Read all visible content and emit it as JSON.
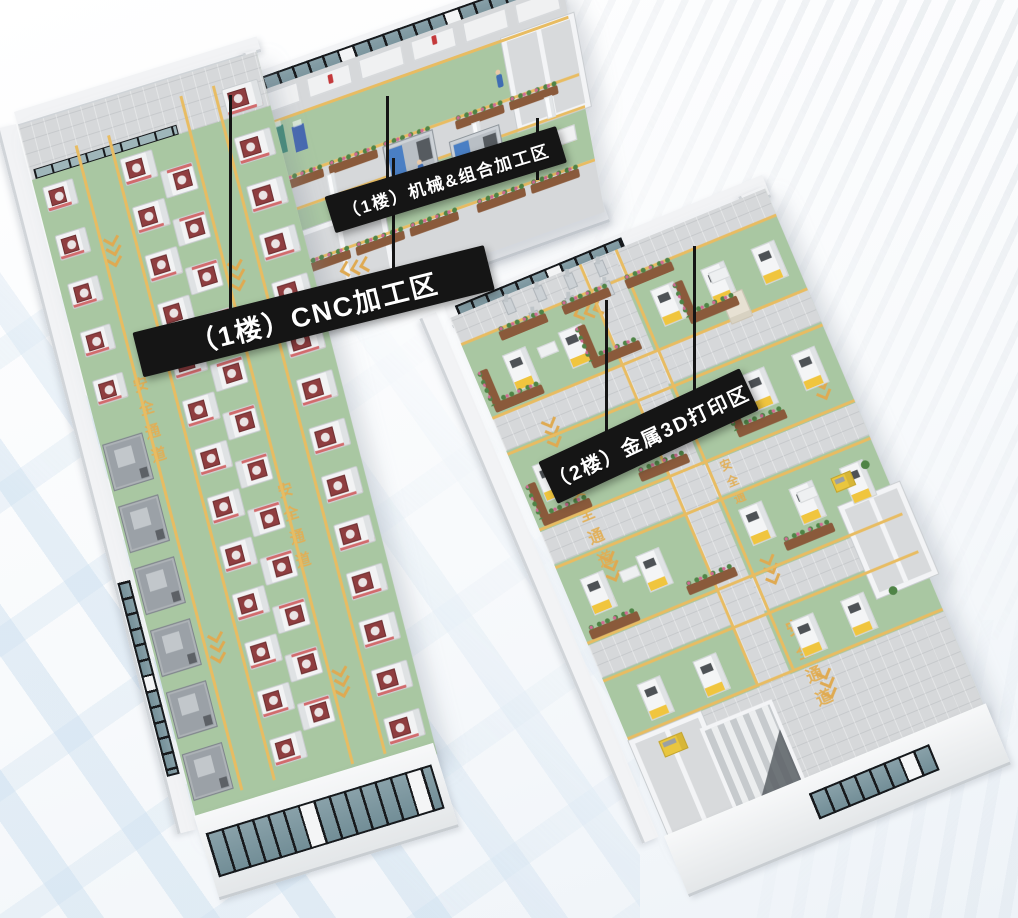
{
  "zones": [
    {
      "id": "cnc-floor1",
      "label": "（1楼）CNC加工区"
    },
    {
      "id": "machining-floor1",
      "label": "（1楼）机械&组合加工区"
    },
    {
      "id": "printing-floor2",
      "label": "（2楼）金属3D打印区"
    }
  ],
  "floor_markings": {
    "safety_text": "安全通道"
  },
  "colors": {
    "floor_green": "#a9c7a2",
    "aisle_gray": "#d6d8da",
    "lane_yellow": "#e8bc62",
    "banner_bg": "#151515",
    "banner_text": "#ffffff",
    "glass": "#7e98a1",
    "window_frame": "#17191c",
    "printer_yellow": "#f0c53e"
  }
}
